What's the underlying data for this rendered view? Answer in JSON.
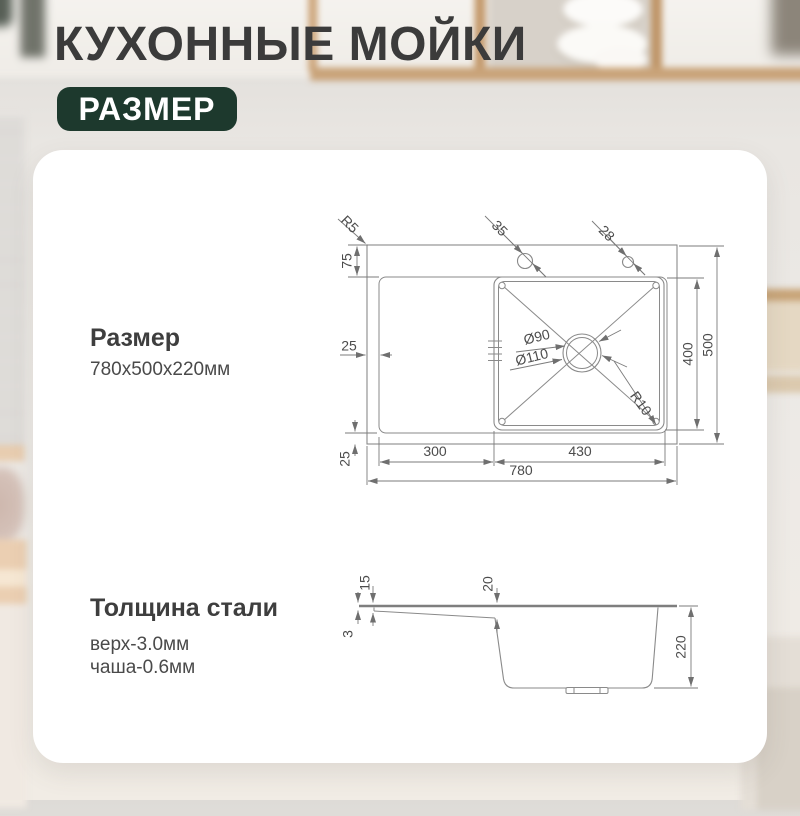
{
  "header": {
    "title": "КУХОННЫЕ МОЙКИ",
    "badge": "РАЗМЕР"
  },
  "sections": {
    "size": {
      "title": "Размер",
      "value": "780x500x220мм"
    },
    "thickness": {
      "title": "Толщина стали",
      "top": "верх-3.0мм",
      "bowl": "чаша-0.6мм"
    }
  },
  "drawing": {
    "top_view": {
      "corner_radius_label": "R5",
      "faucet_hole_left_label": "35",
      "faucet_hole_right_label": "28",
      "deck_top_label": "75",
      "rim_left_label": "25",
      "rim_bottom_label": "25",
      "drain_inner_label": "Ø90",
      "drain_outer_label": "Ø110",
      "bowl_corner_radius_label": "R10",
      "bowl_depth_label": "400",
      "total_width_label": "500",
      "wing_length_label": "300",
      "bowl_length_label": "430",
      "total_length_label": "780"
    },
    "side_view": {
      "top_thickness_label": "3",
      "edge_height_label": "15",
      "wing_drop_label": "20",
      "total_height_label": "220"
    }
  },
  "colors": {
    "badge_background": "#1d392d",
    "title_text": "#3b3b3b",
    "drawing_lines": "#8a8a8a",
    "dimension_text": "#4c4c4c",
    "card_background": "#ffffff"
  }
}
